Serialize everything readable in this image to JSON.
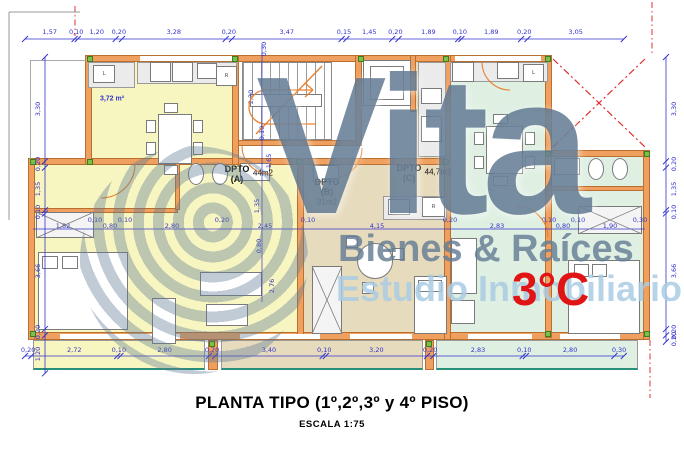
{
  "title": {
    "main": "PLANTA TIPO (1º,2º,3º y 4º PISO)",
    "scale": "ESCALA 1:75"
  },
  "watermark": {
    "brand": "Vita",
    "line1": "Bienes & Raíces",
    "line2": "Estudio Inmobiliario",
    "unit": "3°C"
  },
  "colors": {
    "yellow": "#f8f6c0",
    "tan": "#e7dbbd",
    "mint": "#dff0e3",
    "wall": "#efa05f",
    "wall_border": "#b96f2f",
    "dim_blue": "#3333cc",
    "red": "#dd2020",
    "teal": "#2a8f7a",
    "counter": "#ebebeb"
  },
  "plan": {
    "rooms": [
      {
        "x": 88,
        "y": 58,
        "w": 149,
        "h": 104,
        "f": "yellow"
      },
      {
        "x": 28,
        "y": 160,
        "w": 274,
        "h": 174,
        "f": "yellow"
      },
      {
        "x": 302,
        "y": 160,
        "w": 145,
        "h": 174,
        "f": "tan"
      },
      {
        "x": 415,
        "y": 58,
        "w": 32,
        "h": 104,
        "f": "tan"
      },
      {
        "x": 447,
        "y": 58,
        "w": 101,
        "h": 276,
        "f": "mint"
      },
      {
        "x": 548,
        "y": 155,
        "w": 98,
        "h": 179,
        "f": "mint"
      },
      {
        "x": 33,
        "y": 340,
        "w": 172,
        "h": 30,
        "f": "yellow",
        "b": 1
      },
      {
        "x": 221,
        "y": 340,
        "w": 202,
        "h": 30,
        "f": "tan",
        "b": 1
      },
      {
        "x": 436,
        "y": 340,
        "w": 202,
        "h": 30,
        "f": "mint",
        "b": 1
      }
    ],
    "walls": [
      {
        "x": 85,
        "y": 55,
        "w": 466,
        "h": 7
      },
      {
        "x": 28,
        "y": 158,
        "w": 422,
        "h": 7
      },
      {
        "x": 28,
        "y": 332,
        "w": 622,
        "h": 8
      },
      {
        "x": 545,
        "y": 150,
        "w": 105,
        "h": 7
      },
      {
        "x": 237,
        "y": 140,
        "w": 125,
        "h": 6
      },
      {
        "x": 28,
        "y": 208,
        "w": 150,
        "h": 5
      },
      {
        "x": 548,
        "y": 186,
        "w": 100,
        "h": 5
      },
      {
        "x": 85,
        "y": 55,
        "w": 7,
        "h": 110
      },
      {
        "x": 28,
        "y": 158,
        "w": 7,
        "h": 182
      },
      {
        "x": 232,
        "y": 55,
        "w": 7,
        "h": 110
      },
      {
        "x": 297,
        "y": 158,
        "w": 7,
        "h": 182
      },
      {
        "x": 355,
        "y": 55,
        "w": 7,
        "h": 91
      },
      {
        "x": 410,
        "y": 55,
        "w": 6,
        "h": 57
      },
      {
        "x": 444,
        "y": 55,
        "w": 7,
        "h": 285
      },
      {
        "x": 545,
        "y": 55,
        "w": 7,
        "h": 283
      },
      {
        "x": 643,
        "y": 150,
        "w": 7,
        "h": 190
      },
      {
        "x": 175,
        "y": 160,
        "w": 5,
        "h": 50
      },
      {
        "x": 208,
        "y": 340,
        "w": 10,
        "h": 30
      },
      {
        "x": 425,
        "y": 340,
        "w": 9,
        "h": 30
      }
    ],
    "counters": [
      {
        "x": 137,
        "y": 62,
        "w": 100,
        "h": 22
      },
      {
        "x": 450,
        "y": 62,
        "w": 98,
        "h": 20
      },
      {
        "x": 418,
        "y": 62,
        "w": 28,
        "h": 95
      },
      {
        "x": 383,
        "y": 196,
        "w": 64,
        "h": 24
      },
      {
        "x": 88,
        "y": 62,
        "w": 47,
        "h": 26
      }
    ],
    "windows": [
      {
        "x": 140,
        "y": 56,
        "w": 92,
        "h": 5,
        "c": "#ffffff"
      },
      {
        "x": 455,
        "y": 56,
        "w": 86,
        "h": 5,
        "c": "#ffffff"
      },
      {
        "x": 60,
        "y": 334,
        "w": 120,
        "h": 5,
        "c": "#ffffff"
      },
      {
        "x": 240,
        "y": 334,
        "w": 80,
        "h": 5,
        "c": "#ffffff"
      },
      {
        "x": 350,
        "y": 334,
        "w": 62,
        "h": 5,
        "c": "#ffffff"
      },
      {
        "x": 468,
        "y": 334,
        "w": 64,
        "h": 5,
        "c": "#ffffff"
      },
      {
        "x": 560,
        "y": 334,
        "w": 60,
        "h": 5,
        "c": "#ffffff"
      },
      {
        "x": 30,
        "y": 60,
        "w": 56,
        "h": 1,
        "c": "#aaaaaa"
      },
      {
        "x": 30,
        "y": 60,
        "w": 1,
        "h": 100,
        "c": "#aaaaaa"
      }
    ],
    "stairs": {
      "x": 242,
      "y": 62,
      "w": 90,
      "h": 78
    },
    "fixtures": [
      {
        "x": 93,
        "y": 65,
        "w": 22,
        "h": 18,
        "l": "L"
      },
      {
        "x": 150,
        "y": 62,
        "w": 21,
        "h": 20
      },
      {
        "x": 172,
        "y": 62,
        "w": 21,
        "h": 20
      },
      {
        "x": 197,
        "y": 63,
        "w": 20,
        "h": 16
      },
      {
        "x": 216,
        "y": 66,
        "w": 21,
        "h": 20,
        "l": "R"
      },
      {
        "x": 158,
        "y": 114,
        "w": 34,
        "h": 50
      },
      {
        "x": 146,
        "y": 120,
        "w": 10,
        "h": 13
      },
      {
        "x": 146,
        "y": 142,
        "w": 10,
        "h": 13
      },
      {
        "x": 193,
        "y": 120,
        "w": 10,
        "h": 13
      },
      {
        "x": 193,
        "y": 142,
        "w": 10,
        "h": 13
      },
      {
        "x": 164,
        "y": 103,
        "w": 14,
        "h": 10
      },
      {
        "x": 164,
        "y": 165,
        "w": 14,
        "h": 10
      },
      {
        "x": 188,
        "y": 163,
        "w": 16,
        "h": 22,
        "e": 1
      },
      {
        "x": 212,
        "y": 163,
        "w": 16,
        "h": 22,
        "e": 1
      },
      {
        "x": 240,
        "y": 163,
        "w": 30,
        "h": 18
      },
      {
        "x": 38,
        "y": 252,
        "w": 90,
        "h": 78
      },
      {
        "x": 42,
        "y": 256,
        "w": 16,
        "h": 13
      },
      {
        "x": 62,
        "y": 256,
        "w": 16,
        "h": 13
      },
      {
        "x": 200,
        "y": 272,
        "w": 62,
        "h": 24
      },
      {
        "x": 152,
        "y": 298,
        "w": 24,
        "h": 46
      },
      {
        "x": 206,
        "y": 304,
        "w": 42,
        "h": 22
      },
      {
        "x": 313,
        "y": 165,
        "w": 26,
        "h": 17
      },
      {
        "x": 421,
        "y": 88,
        "w": 21,
        "h": 16
      },
      {
        "x": 421,
        "y": 116,
        "w": 21,
        "h": 26
      },
      {
        "x": 388,
        "y": 199,
        "w": 22,
        "h": 16
      },
      {
        "x": 422,
        "y": 197,
        "w": 23,
        "h": 20,
        "l": "R"
      },
      {
        "x": 357,
        "y": 243,
        "w": 36,
        "h": 36,
        "e": 1
      },
      {
        "x": 346,
        "y": 236,
        "w": 12,
        "h": 12
      },
      {
        "x": 392,
        "y": 248,
        "w": 12,
        "h": 12
      },
      {
        "x": 362,
        "y": 282,
        "w": 12,
        "h": 12
      },
      {
        "x": 414,
        "y": 276,
        "w": 33,
        "h": 58
      },
      {
        "x": 418,
        "y": 280,
        "w": 24,
        "h": 12
      },
      {
        "x": 452,
        "y": 62,
        "w": 22,
        "h": 20
      },
      {
        "x": 497,
        "y": 62,
        "w": 22,
        "h": 17
      },
      {
        "x": 523,
        "y": 64,
        "w": 21,
        "h": 18,
        "l": "L"
      },
      {
        "x": 486,
        "y": 126,
        "w": 37,
        "h": 48
      },
      {
        "x": 474,
        "y": 132,
        "w": 10,
        "h": 13
      },
      {
        "x": 525,
        "y": 132,
        "w": 10,
        "h": 13
      },
      {
        "x": 474,
        "y": 156,
        "w": 10,
        "h": 13
      },
      {
        "x": 525,
        "y": 156,
        "w": 10,
        "h": 13
      },
      {
        "x": 493,
        "y": 114,
        "w": 15,
        "h": 10
      },
      {
        "x": 493,
        "y": 176,
        "w": 15,
        "h": 10
      },
      {
        "x": 451,
        "y": 238,
        "w": 26,
        "h": 56
      },
      {
        "x": 451,
        "y": 300,
        "w": 24,
        "h": 24
      },
      {
        "x": 554,
        "y": 158,
        "w": 26,
        "h": 17
      },
      {
        "x": 588,
        "y": 158,
        "w": 16,
        "h": 22,
        "e": 1
      },
      {
        "x": 612,
        "y": 158,
        "w": 16,
        "h": 22,
        "e": 1
      },
      {
        "x": 568,
        "y": 260,
        "w": 72,
        "h": 74
      },
      {
        "x": 574,
        "y": 264,
        "w": 15,
        "h": 13
      },
      {
        "x": 592,
        "y": 264,
        "w": 15,
        "h": 13
      },
      {
        "x": 363,
        "y": 60,
        "w": 48,
        "h": 46
      },
      {
        "x": 370,
        "y": 66,
        "w": 34,
        "h": 34
      },
      {
        "x": 250,
        "y": 94,
        "w": 72,
        "h": 13
      }
    ],
    "xboxes": [
      {
        "x": 36,
        "y": 212,
        "w": 58,
        "h": 26
      },
      {
        "x": 312,
        "y": 266,
        "w": 30,
        "h": 68
      },
      {
        "x": 578,
        "y": 206,
        "w": 64,
        "h": 28
      }
    ],
    "labels": [
      {
        "t": "3,72 m²",
        "x": 112,
        "y": 99,
        "s": 7,
        "c": "#3333cc",
        "b": 1
      },
      {
        "t": "DPTO",
        "x": 237,
        "y": 169,
        "s": 9,
        "b": 1
      },
      {
        "t": "(A)",
        "x": 237,
        "y": 179,
        "s": 9,
        "b": 1
      },
      {
        "t": "44m2",
        "x": 263,
        "y": 173,
        "s": 8
      },
      {
        "t": "DPTO",
        "x": 327,
        "y": 182,
        "s": 9,
        "b": 1
      },
      {
        "t": "(B)",
        "x": 327,
        "y": 192,
        "s": 9,
        "b": 1
      },
      {
        "t": "31m2",
        "x": 327,
        "y": 202,
        "s": 8
      },
      {
        "t": "DPTO",
        "x": 409,
        "y": 168,
        "s": 9,
        "b": 1
      },
      {
        "t": "(C)",
        "x": 409,
        "y": 178,
        "s": 9,
        "b": 1
      },
      {
        "t": "44,7m2",
        "x": 438,
        "y": 172,
        "s": 8
      }
    ],
    "cols": [
      {
        "x": 87,
        "y": 56
      },
      {
        "x": 232,
        "y": 56
      },
      {
        "x": 358,
        "y": 56
      },
      {
        "x": 443,
        "y": 56
      },
      {
        "x": 545,
        "y": 56
      },
      {
        "x": 30,
        "y": 159
      },
      {
        "x": 87,
        "y": 159
      },
      {
        "x": 296,
        "y": 159
      },
      {
        "x": 443,
        "y": 159
      },
      {
        "x": 545,
        "y": 151
      },
      {
        "x": 644,
        "y": 151
      },
      {
        "x": 30,
        "y": 331
      },
      {
        "x": 209,
        "y": 341
      },
      {
        "x": 426,
        "y": 341
      },
      {
        "x": 545,
        "y": 331
      },
      {
        "x": 644,
        "y": 331
      }
    ],
    "dims": {
      "scale": 31.6,
      "top": {
        "p": 39,
        "o": 25,
        "lo": -7,
        "segs": [
          1.57,
          0.1,
          1.2,
          0.2,
          3.28,
          0.2,
          3.47,
          0.15,
          1.45,
          0.2,
          1.89,
          0.1,
          1.89,
          0.2,
          3.05
        ]
      },
      "bottom": {
        "p": 356,
        "o": 25,
        "lo": -6,
        "segs": [
          0.2,
          2.72,
          0.1,
          2.8,
          0.2,
          3.4,
          0.1,
          3.2,
          0.2,
          2.83,
          0.1,
          2.8,
          0.3
        ]
      },
      "left": {
        "p": 45,
        "o": 57,
        "lo": -7,
        "segs": [
          3.3,
          0.2,
          1.35,
          0.1,
          3.66,
          0.2,
          1.2
        ]
      },
      "right": {
        "p": 666,
        "o": 57,
        "lo": 8,
        "segs": [
          3.3,
          0.2,
          1.35,
          0.1,
          3.66,
          0.2,
          0.2
        ]
      },
      "inner": [
        {
          "t": "2,20",
          "x": 251,
          "y": 97,
          "r": 1
        },
        {
          "t": "0,30",
          "x": 264,
          "y": 49,
          "r": 1
        },
        {
          "t": "0,10",
          "x": 262,
          "y": 133,
          "r": 1
        },
        {
          "t": "1,65",
          "x": 269,
          "y": 161,
          "r": 1
        },
        {
          "t": "1,35",
          "x": 257,
          "y": 206,
          "r": 1
        },
        {
          "t": "0,80",
          "x": 259,
          "y": 246,
          "r": 1
        },
        {
          "t": "2,76",
          "x": 272,
          "y": 286,
          "r": 1
        },
        {
          "t": "1,82",
          "x": 63,
          "y": 226
        },
        {
          "t": "0,10",
          "x": 95,
          "y": 220
        },
        {
          "t": "0,80",
          "x": 110,
          "y": 226
        },
        {
          "t": "0,10",
          "x": 125,
          "y": 220
        },
        {
          "t": "2,80",
          "x": 172,
          "y": 226
        },
        {
          "t": "0,20",
          "x": 222,
          "y": 220
        },
        {
          "t": "2,45",
          "x": 265,
          "y": 226
        },
        {
          "t": "0,10",
          "x": 308,
          "y": 220
        },
        {
          "t": "4,15",
          "x": 377,
          "y": 226
        },
        {
          "t": "0,20",
          "x": 450,
          "y": 220
        },
        {
          "t": "2,83",
          "x": 497,
          "y": 226
        },
        {
          "t": "0,10",
          "x": 549,
          "y": 220
        },
        {
          "t": "0,80",
          "x": 563,
          "y": 226
        },
        {
          "t": "0,10",
          "x": 578,
          "y": 220
        },
        {
          "t": "1,90",
          "x": 610,
          "y": 226
        },
        {
          "t": "0,30",
          "x": 640,
          "y": 220
        }
      ]
    },
    "svg": [
      {
        "k": "line",
        "x1": 553,
        "y1": 59,
        "x2": 645,
        "y2": 147,
        "s": "#e03030",
        "w": 1.2,
        "d": "7 3 2 3"
      },
      {
        "k": "line",
        "x1": 645,
        "y1": 59,
        "x2": 553,
        "y2": 147,
        "s": "#e03030",
        "w": 1.2,
        "d": "7 3 2 3"
      },
      {
        "k": "line",
        "x1": 75,
        "y1": 6,
        "x2": 75,
        "y2": 36,
        "s": "#e03030",
        "w": 1,
        "d": "6 3 1.5 3"
      },
      {
        "k": "line",
        "x1": 652,
        "y1": 2,
        "x2": 652,
        "y2": 56,
        "s": "#e03030",
        "w": 1,
        "d": "6 3 1.5 3"
      },
      {
        "k": "line",
        "x1": 650,
        "y1": 340,
        "x2": 650,
        "y2": 398,
        "s": "#e03030",
        "w": 1,
        "d": "6 3 1.5 3"
      },
      {
        "k": "line",
        "x1": 9,
        "y1": 12,
        "x2": 9,
        "y2": 220,
        "s": "#9a9a9a",
        "w": 1
      },
      {
        "k": "line",
        "x1": 9,
        "y1": 12,
        "x2": 80,
        "y2": 12,
        "s": "#9a9a9a",
        "w": 1
      },
      {
        "k": "line",
        "x1": 256,
        "y1": 134,
        "x2": 322,
        "y2": 66,
        "s": "#e8822f",
        "w": 1.4
      },
      {
        "k": "path",
        "d": "M 316 124 H 266 a 17 17 0 0 1 0 -34 H 312",
        "s": "#e8822f",
        "w": 1.3
      },
      {
        "k": "line",
        "x1": 305,
        "y1": 83,
        "x2": 313,
        "y2": 90,
        "s": "#e8822f",
        "w": 1.3
      },
      {
        "k": "line",
        "x1": 305,
        "y1": 97,
        "x2": 313,
        "y2": 90,
        "s": "#e8822f",
        "w": 1.3
      },
      {
        "k": "path",
        "d": "M 242 146 A 28 28 0 0 0 270 174",
        "s": "#e8822f",
        "w": 1.1
      },
      {
        "k": "path",
        "d": "M 362 148 A 30 30 0 0 1 332 178",
        "s": "#e8822f",
        "w": 1.1
      },
      {
        "k": "path",
        "d": "M 482 62 A 28 28 0 0 0 510 90",
        "s": "#e8822f",
        "w": 1.1
      },
      {
        "k": "path",
        "d": "M 516 206 A 32 32 0 0 1 548 238",
        "s": "#e8822f",
        "w": 1.1
      },
      {
        "k": "path",
        "d": "M 135 164 A 34 34 0 0 1 101 198",
        "s": "#e8822f",
        "w": 1.1
      },
      {
        "k": "line",
        "x1": 33,
        "y1": 229,
        "x2": 645,
        "y2": 229,
        "s": "#3333cc",
        "w": 0.7
      },
      {
        "k": "line",
        "x1": 262,
        "y1": 45,
        "x2": 262,
        "y2": 302,
        "s": "#3333cc",
        "w": 0.7
      }
    ]
  }
}
